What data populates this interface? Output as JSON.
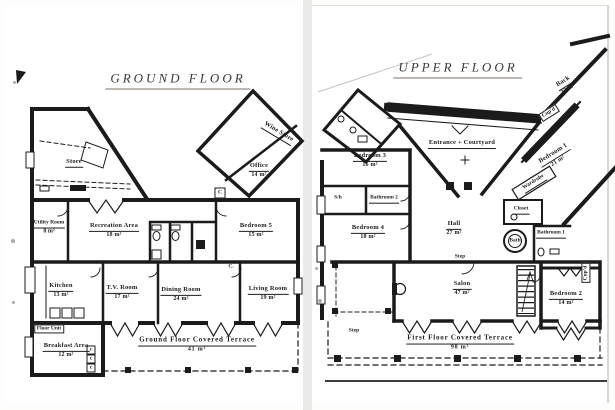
{
  "colors": {
    "ink": "#1b1b1b",
    "paper": "#ffffff"
  },
  "ground_floor": {
    "title": "GROUND FLOOR",
    "rooms": {
      "store": {
        "name": "Store",
        "area": ""
      },
      "wine_store": {
        "name": "Wine Store",
        "area": ""
      },
      "office": {
        "name": "Office",
        "area": "14 m²"
      },
      "utility_room": {
        "name": "Utility Room",
        "area": "8 m²"
      },
      "recreation_area": {
        "name": "Recreation Area",
        "area": "18 m²"
      },
      "bedroom_5": {
        "name": "Bedroom 5",
        "area": "15 m²"
      },
      "kitchen": {
        "name": "Kitchen",
        "area": "13 m²"
      },
      "tv_room": {
        "name": "T.V. Room",
        "area": "17 m²"
      },
      "dining_room": {
        "name": "Dining Room",
        "area": "24 m²"
      },
      "living_room": {
        "name": "Living Room",
        "area": "19 m²"
      },
      "breakfast_area": {
        "name": "Breakfast Area",
        "area": "12 m²"
      },
      "terrace": {
        "name": "Ground Floor Covered Terrace",
        "area": "41 m²"
      }
    },
    "annotations": {
      "floor_unit": "Floor Unit",
      "cupboard_office": "C",
      "cupboard_dining": "C.",
      "c1": "c",
      "c2": "c",
      "c3": "c"
    }
  },
  "upper_floor": {
    "title": "UPPER FLOOR",
    "rooms": {
      "entrance_courtyard": {
        "name": "Entrance + Courtyard",
        "area": ""
      },
      "bedroom_3": {
        "name": "Bedroom 3",
        "area": "16 m²"
      },
      "bathroom_2": {
        "name": "Bathroom 2",
        "area": ""
      },
      "bedroom_4": {
        "name": "Bedroom 4",
        "area": "18 m²"
      },
      "hall": {
        "name": "Hall",
        "area": "27 m²"
      },
      "closet": {
        "name": "Closet",
        "area": ""
      },
      "wardrobe": {
        "name": "Wardrobe",
        "area": ""
      },
      "bedroom_1": {
        "name": "Bedroom 1",
        "area": "21 m²"
      },
      "back_room": {
        "name": "Back",
        "area": "32 m²"
      },
      "bath": {
        "name": "Bath",
        "area": ""
      },
      "bathroom_1": {
        "name": "Bathroom 1",
        "area": ""
      },
      "salon": {
        "name": "Salon",
        "area": "47 m²"
      },
      "bedroom_2": {
        "name": "Bedroom 2",
        "area": "14 m²"
      },
      "terrace": {
        "name": "First Floor Covered Terrace",
        "area": "98 m²"
      }
    },
    "annotations": {
      "cupboard_corridor": "Cup'd",
      "cupboard_bedroom2": "Cup'd",
      "shower": "S/h",
      "step_hall": "Step",
      "step_terrace": "Step"
    }
  }
}
